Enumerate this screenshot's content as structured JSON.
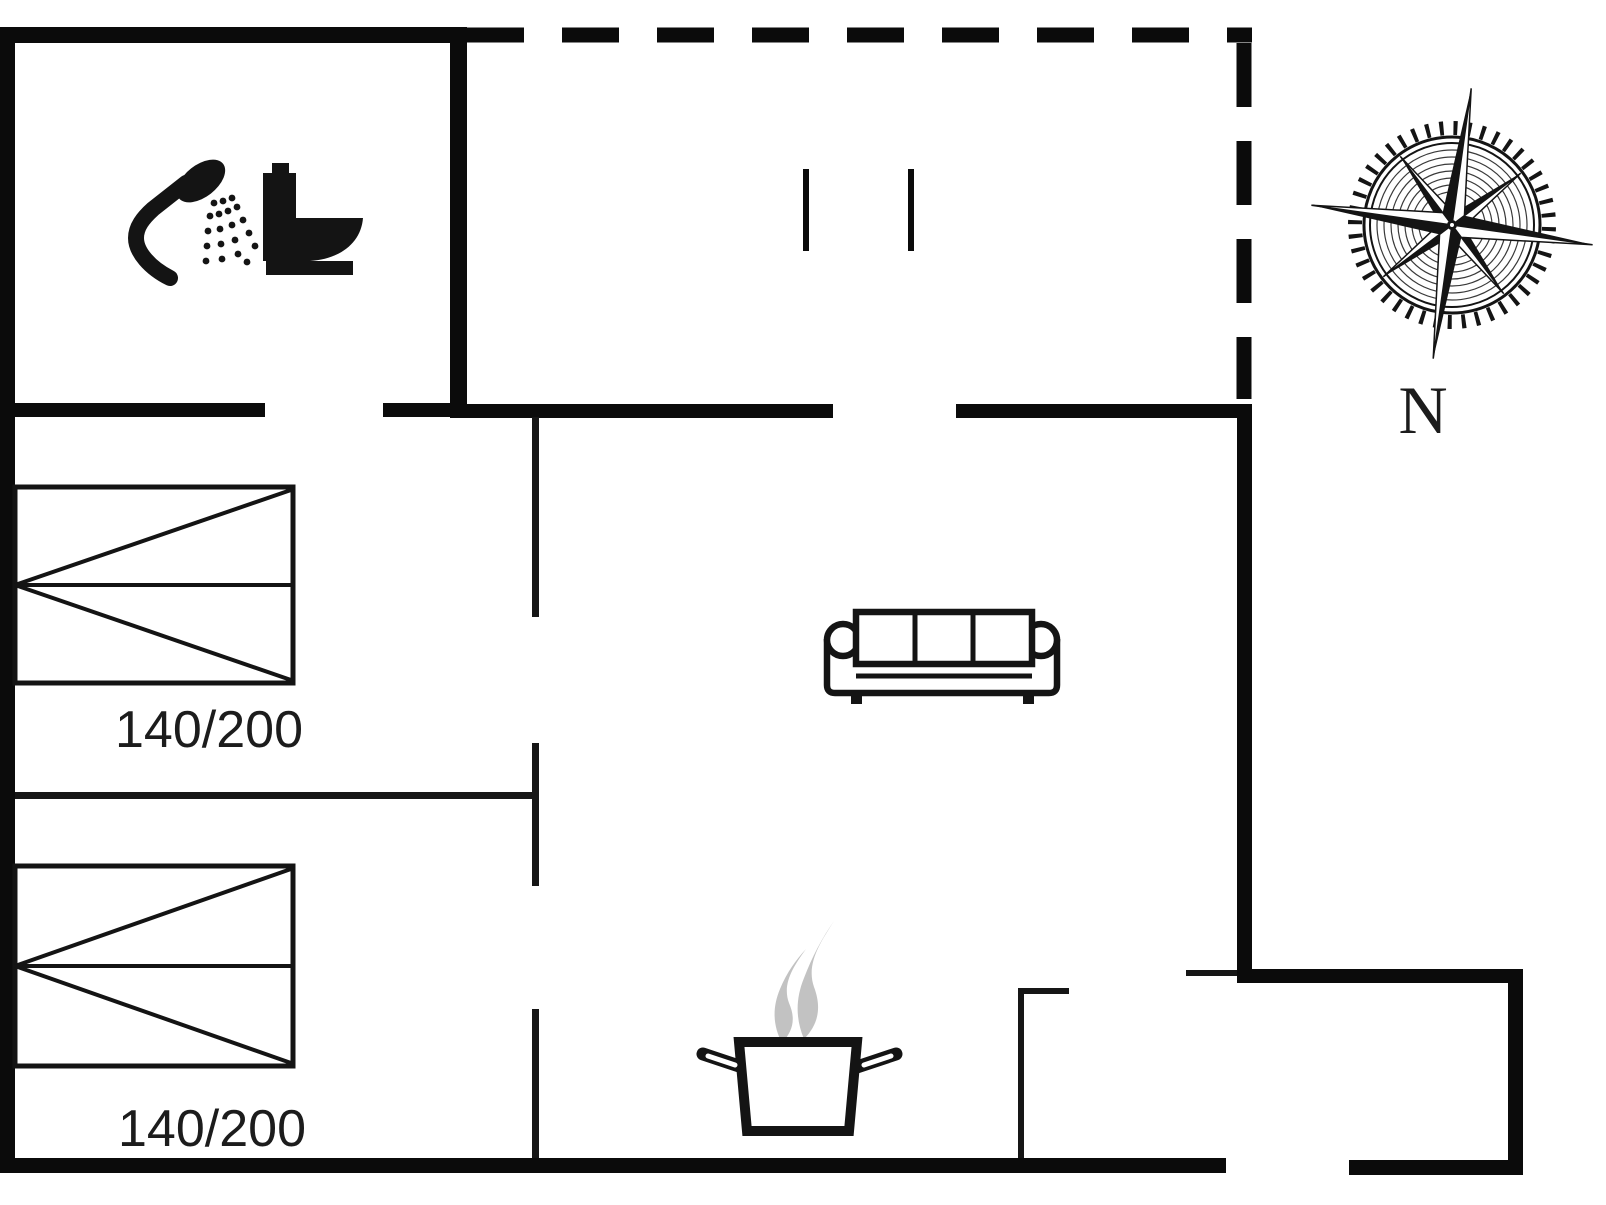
{
  "meta": {
    "type": "floor-plan",
    "title": "Holiday house floor plan"
  },
  "canvas": {
    "width": 1606,
    "height": 1205,
    "background": "#ffffff"
  },
  "colors": {
    "wall": "#0b0b0b",
    "thin_wall": "#161616",
    "icon": "#141414",
    "steam": "#c2c2c2",
    "text": "#1c1c1c",
    "white": "#ffffff",
    "engrave": "#3a3a3a"
  },
  "labels": {
    "bed1": "140/200",
    "bed2": "140/200",
    "north": "N"
  },
  "compass": {
    "cx": 1452,
    "cy": 225,
    "rotation_deg": 8
  },
  "shapes": [
    {
      "name": "wall-bathroom-top",
      "type": "rect",
      "x": 0,
      "y": 27,
      "w": 467,
      "h": 16
    },
    {
      "name": "wall-outer-left",
      "type": "rect",
      "x": 0,
      "y": 27,
      "w": 15,
      "h": 1146
    },
    {
      "name": "wall-bathroom-right",
      "type": "rect",
      "x": 450,
      "y": 27,
      "w": 17,
      "h": 391
    },
    {
      "name": "wall-bathroom-bottom-a",
      "type": "rect",
      "x": 15,
      "y": 403,
      "w": 250,
      "h": 14
    },
    {
      "name": "wall-bathroom-bottom-b",
      "type": "rect",
      "x": 383,
      "y": 403,
      "w": 67,
      "h": 14
    },
    {
      "name": "wall-hall-top",
      "type": "rect",
      "x": 467,
      "y": 404,
      "w": 366,
      "h": 14
    },
    {
      "name": "wall-living-top",
      "type": "rect",
      "x": 956,
      "y": 404,
      "w": 296,
      "h": 14
    },
    {
      "name": "wall-living-right",
      "type": "rect",
      "x": 1237,
      "y": 404,
      "w": 15,
      "h": 579
    },
    {
      "name": "wall-annex-top",
      "type": "rect",
      "x": 1237,
      "y": 969,
      "w": 286,
      "h": 14
    },
    {
      "name": "wall-annex-right",
      "type": "rect",
      "x": 1508,
      "y": 969,
      "w": 15,
      "h": 206
    },
    {
      "name": "wall-bottom-main",
      "type": "rect",
      "x": 0,
      "y": 1158,
      "w": 1226,
      "h": 15
    },
    {
      "name": "wall-bottom-annex",
      "type": "rect",
      "x": 1349,
      "y": 1160,
      "w": 174,
      "h": 15
    },
    {
      "name": "wall-hall-upper",
      "type": "rect",
      "x": 532,
      "y": 417,
      "w": 7,
      "h": 200,
      "fill": "#161616"
    },
    {
      "name": "wall-hall-middle",
      "type": "rect",
      "x": 532,
      "y": 743,
      "w": 7,
      "h": 143,
      "fill": "#161616"
    },
    {
      "name": "wall-hall-lower",
      "type": "rect",
      "x": 532,
      "y": 1009,
      "w": 7,
      "h": 149,
      "fill": "#161616"
    },
    {
      "name": "wall-bedroom-divider",
      "type": "rect",
      "x": 15,
      "y": 792,
      "w": 520,
      "h": 7,
      "fill": "#161616"
    },
    {
      "name": "wall-kitchen-vertical",
      "type": "rect",
      "x": 1018,
      "y": 988,
      "w": 6,
      "h": 170,
      "fill": "#161616"
    },
    {
      "name": "wall-kitchen-stub",
      "type": "rect",
      "x": 1018,
      "y": 988,
      "w": 51,
      "h": 6,
      "fill": "#161616"
    },
    {
      "name": "wall-annex-stub",
      "type": "rect",
      "x": 1186,
      "y": 970,
      "w": 51,
      "h": 6,
      "fill": "#161616"
    },
    {
      "name": "wall-terrace-top-dashed",
      "type": "line",
      "x1": 467,
      "y1": 35,
      "x2": 1252,
      "y2": 35,
      "sw": 15,
      "dash": "57 38"
    },
    {
      "name": "wall-terrace-right-dashed",
      "type": "line",
      "x1": 1244,
      "y1": 43,
      "x2": 1244,
      "y2": 399,
      "sw": 15,
      "dash": "64 34"
    },
    {
      "name": "terrace-door-mark-left",
      "type": "rect",
      "x": 803,
      "y": 169,
      "w": 6,
      "h": 82
    },
    {
      "name": "terrace-door-mark-right",
      "type": "rect",
      "x": 908,
      "y": 169,
      "w": 6,
      "h": 82
    },
    {
      "name": "bed1-frame",
      "type": "rect",
      "x": 15,
      "y": 487,
      "w": 278,
      "h": 196,
      "fill": "#ffffff",
      "stroke": "#141414",
      "sw": 5
    },
    {
      "name": "bed1-midline",
      "type": "line",
      "x1": 15,
      "y1": 585,
      "x2": 293,
      "y2": 585,
      "sw": 4,
      "stroke": "#141414"
    },
    {
      "name": "bed1-diag-up",
      "type": "line",
      "x1": 15,
      "y1": 585,
      "x2": 291,
      "y2": 490,
      "sw": 4,
      "stroke": "#141414"
    },
    {
      "name": "bed1-diag-down",
      "type": "line",
      "x1": 15,
      "y1": 585,
      "x2": 291,
      "y2": 680,
      "sw": 4,
      "stroke": "#141414"
    },
    {
      "name": "bed2-frame",
      "type": "rect",
      "x": 15,
      "y": 866,
      "w": 278,
      "h": 200,
      "fill": "#ffffff",
      "stroke": "#141414",
      "sw": 5
    },
    {
      "name": "bed2-midline",
      "type": "line",
      "x1": 15,
      "y1": 966,
      "x2": 293,
      "y2": 966,
      "sw": 4,
      "stroke": "#141414"
    },
    {
      "name": "bed2-diag-up",
      "type": "line",
      "x1": 15,
      "y1": 966,
      "x2": 291,
      "y2": 869,
      "sw": 4,
      "stroke": "#141414"
    },
    {
      "name": "bed2-diag-down",
      "type": "line",
      "x1": 15,
      "y1": 966,
      "x2": 291,
      "y2": 1063,
      "sw": 4,
      "stroke": "#141414"
    },
    {
      "name": "sofa-foot-left",
      "type": "rect",
      "x": 851,
      "y": 691,
      "w": 11,
      "h": 13,
      "fill": "#141414"
    },
    {
      "name": "sofa-foot-right",
      "type": "rect",
      "x": 1023,
      "y": 691,
      "w": 11,
      "h": 13,
      "fill": "#141414"
    },
    {
      "name": "sofa-frame",
      "type": "path",
      "d": "M 827,639 L 827,685 Q 827,693 835,693 L 1049,693 Q 1057,693 1057,685 L 1057,639",
      "fill": "#ffffff",
      "stroke": "#141414",
      "sw": 6.5
    },
    {
      "name": "sofa-arm-left",
      "type": "circle",
      "cx": 843,
      "cy": 640,
      "r": 16,
      "fill": "#ffffff",
      "stroke": "#141414",
      "sw": 6.5
    },
    {
      "name": "sofa-arm-right",
      "type": "circle",
      "cx": 1041,
      "cy": 640,
      "r": 16,
      "fill": "#ffffff",
      "stroke": "#141414",
      "sw": 6.5
    },
    {
      "name": "sofa-cushions",
      "type": "rect",
      "x": 856,
      "y": 612,
      "w": 176,
      "h": 52,
      "fill": "#ffffff",
      "stroke": "#141414",
      "sw": 6.5
    },
    {
      "name": "sofa-cushion-div1",
      "type": "line",
      "x1": 915,
      "y1": 612,
      "x2": 915,
      "y2": 664,
      "sw": 5,
      "stroke": "#141414"
    },
    {
      "name": "sofa-cushion-div2",
      "type": "line",
      "x1": 973,
      "y1": 612,
      "x2": 973,
      "y2": 664,
      "sw": 5,
      "stroke": "#141414"
    },
    {
      "name": "sofa-seat-edge",
      "type": "line",
      "x1": 856,
      "y1": 676,
      "x2": 1032,
      "y2": 676,
      "sw": 5,
      "stroke": "#141414"
    },
    {
      "name": "steam-wisp-left",
      "type": "path",
      "d": "M 806,949 C 793,967 782,984 789,1003 C 796,1019 793,1031 782,1043 C 773,1026 772,1008 780,989 C 787,972 796,960 806,949 Z",
      "fill": "#c2c2c2"
    },
    {
      "name": "steam-wisp-right",
      "type": "path",
      "d": "M 834,921 C 820,943 806,964 814,987 C 822,1008 818,1025 804,1039 C 796,1020 795,1000 804,978 C 812,957 822,938 834,921 Z",
      "fill": "#c2c2c2"
    },
    {
      "name": "pot-handle-left",
      "type": "line",
      "x1": 703,
      "y1": 1054,
      "x2": 745,
      "y2": 1068,
      "sw": 13,
      "stroke": "#141414",
      "cap": "round"
    },
    {
      "name": "pot-handle-right",
      "type": "line",
      "x1": 896,
      "y1": 1054,
      "x2": 854,
      "y2": 1068,
      "sw": 13,
      "stroke": "#141414",
      "cap": "round"
    },
    {
      "name": "pot-body",
      "type": "path",
      "d": "M 739,1042 L 857,1042 L 849,1131 L 747,1131 Z",
      "fill": "#ffffff",
      "stroke": "#141414",
      "sw": 10
    },
    {
      "name": "pot-handle-left-inner",
      "type": "line",
      "x1": 708,
      "y1": 1056,
      "x2": 735,
      "y2": 1065,
      "sw": 5,
      "stroke": "#ffffff",
      "cap": "round"
    },
    {
      "name": "pot-handle-right-inner",
      "type": "line",
      "x1": 891,
      "y1": 1056,
      "x2": 864,
      "y2": 1065,
      "sw": 5,
      "stroke": "#ffffff",
      "cap": "round"
    },
    {
      "name": "shower-arm-icon",
      "type": "path",
      "d": "M 170,278 C 150,268 136,252 136,238 C 136,227 143,218 153,209 L 186,183",
      "fill": "none",
      "stroke": "#141414",
      "sw": 16,
      "cap": "round"
    },
    {
      "name": "shower-head-icon",
      "type": "ellipse",
      "cx": 0,
      "cy": 0,
      "rx": 28,
      "ry": 16,
      "fill": "#141414",
      "transform": "translate(201,181) rotate(-38)"
    },
    {
      "name": "shower-spray-dots",
      "type": "dots",
      "r": 3.4,
      "fill": "#141414",
      "pts": [
        [
          214,
          203
        ],
        [
          223,
          201
        ],
        [
          232,
          198
        ],
        [
          210,
          216
        ],
        [
          208,
          231
        ],
        [
          207,
          246
        ],
        [
          206,
          261
        ],
        [
          219,
          214
        ],
        [
          220,
          229
        ],
        [
          221,
          244
        ],
        [
          222,
          259
        ],
        [
          228,
          211
        ],
        [
          232,
          225
        ],
        [
          235,
          240
        ],
        [
          238,
          254
        ],
        [
          237,
          207
        ],
        [
          243,
          220
        ],
        [
          249,
          233
        ],
        [
          255,
          246
        ],
        [
          247,
          262
        ]
      ]
    },
    {
      "name": "toilet-cap-icon",
      "type": "rect",
      "x": 272,
      "y": 163,
      "w": 17,
      "h": 12,
      "fill": "#141414"
    },
    {
      "name": "toilet-tank-icon",
      "type": "rect",
      "x": 263,
      "y": 173,
      "w": 33,
      "h": 72,
      "fill": "#141414"
    },
    {
      "name": "toilet-bowl-icon",
      "type": "path",
      "d": "M 263,218 L 363,218 C 361,243 340,259 310,261 L 263,261 Z",
      "fill": "#141414"
    },
    {
      "name": "toilet-base-icon",
      "type": "rect",
      "x": 266,
      "y": 261,
      "w": 87,
      "h": 14,
      "fill": "#141414"
    },
    {
      "name": "compass-tick-ring",
      "type": "circle",
      "cx": 0,
      "cy": 0,
      "r": 97,
      "fill": "none",
      "stroke": "#141414",
      "sw": 14,
      "dash": "4 9.9",
      "layer": "compass"
    },
    {
      "name": "compass-ring-outer",
      "type": "circle",
      "cx": 0,
      "cy": 0,
      "r": 88,
      "fill": "none",
      "stroke": "#141414",
      "sw": 3,
      "layer": "compass"
    },
    {
      "name": "compass-ring-inner",
      "type": "circle",
      "cx": 0,
      "cy": 0,
      "r": 82,
      "fill": "none",
      "stroke": "#141414",
      "sw": 2,
      "layer": "compass"
    },
    {
      "name": "compass-engrave-1",
      "type": "circle",
      "cx": 0,
      "cy": 0,
      "r": 75,
      "fill": "none",
      "stroke": "#3a3a3a",
      "sw": 1.2,
      "layer": "compass"
    },
    {
      "name": "compass-engrave-2",
      "type": "circle",
      "cx": 0,
      "cy": 0,
      "r": 68,
      "fill": "none",
      "stroke": "#3a3a3a",
      "sw": 1.2,
      "layer": "compass"
    },
    {
      "name": "compass-engrave-3",
      "type": "circle",
      "cx": 0,
      "cy": 0,
      "r": 61,
      "fill": "none",
      "stroke": "#3a3a3a",
      "sw": 1.2,
      "layer": "compass"
    },
    {
      "name": "compass-engrave-4",
      "type": "circle",
      "cx": 0,
      "cy": 0,
      "r": 54,
      "fill": "none",
      "stroke": "#3a3a3a",
      "sw": 1.2,
      "layer": "compass"
    },
    {
      "name": "compass-engrave-5",
      "type": "circle",
      "cx": 0,
      "cy": 0,
      "r": 47,
      "fill": "none",
      "stroke": "#3a3a3a",
      "sw": 1.2,
      "layer": "compass"
    },
    {
      "name": "compass-engrave-6",
      "type": "circle",
      "cx": 0,
      "cy": 0,
      "r": 40,
      "fill": "none",
      "stroke": "#3a3a3a",
      "sw": 1.2,
      "layer": "compass"
    },
    {
      "name": "compass-engrave-7",
      "type": "circle",
      "cx": 0,
      "cy": 0,
      "r": 33,
      "fill": "none",
      "stroke": "#3a3a3a",
      "sw": 1.2,
      "layer": "compass"
    },
    {
      "name": "compass-point-ne-black",
      "type": "poly",
      "points": "60.8,-60.8 0,-12 0,0",
      "fill": "#141414",
      "layer": "compass"
    },
    {
      "name": "compass-point-ne-white",
      "type": "poly",
      "points": "60.8,-60.8 12,0 0,0",
      "fill": "#ffffff",
      "stroke": "#141414",
      "sw": 1.5,
      "layer": "compass"
    },
    {
      "name": "compass-point-se-black",
      "type": "poly",
      "points": "60.8,60.8 12,0 0,0",
      "fill": "#141414",
      "layer": "compass"
    },
    {
      "name": "compass-point-se-white",
      "type": "poly",
      "points": "60.8,60.8 0,12 0,0",
      "fill": "#ffffff",
      "stroke": "#141414",
      "sw": 1.5,
      "layer": "compass"
    },
    {
      "name": "compass-point-sw-black",
      "type": "poly",
      "points": "-60.8,60.8 0,12 0,0",
      "fill": "#141414",
      "layer": "compass"
    },
    {
      "name": "compass-point-sw-white",
      "type": "poly",
      "points": "-60.8,60.8 -12,0 0,0",
      "fill": "#ffffff",
      "stroke": "#141414",
      "sw": 1.5,
      "layer": "compass"
    },
    {
      "name": "compass-point-nw-black",
      "type": "poly",
      "points": "-60.8,-60.8 -12,0 0,0",
      "fill": "#141414",
      "layer": "compass"
    },
    {
      "name": "compass-point-nw-white",
      "type": "poly",
      "points": "-60.8,-60.8 0,-12 0,0",
      "fill": "#ffffff",
      "stroke": "#141414",
      "sw": 1.5,
      "layer": "compass"
    },
    {
      "name": "compass-point-n-black",
      "type": "poly",
      "points": "0,-138 -11,-11 0,0",
      "fill": "#141414",
      "layer": "compass"
    },
    {
      "name": "compass-point-n-white",
      "type": "poly",
      "points": "0,-138 11,-11 0,0",
      "fill": "#ffffff",
      "stroke": "#141414",
      "sw": 1.5,
      "layer": "compass"
    },
    {
      "name": "compass-point-e-black",
      "type": "poly",
      "points": "142,0 11,-11 0,0",
      "fill": "#141414",
      "layer": "compass"
    },
    {
      "name": "compass-point-e-white",
      "type": "poly",
      "points": "142,0 11,11 0,0",
      "fill": "#ffffff",
      "stroke": "#141414",
      "sw": 1.5,
      "layer": "compass"
    },
    {
      "name": "compass-point-s-black",
      "type": "poly",
      "points": "0,135 11,11 0,0",
      "fill": "#141414",
      "layer": "compass"
    },
    {
      "name": "compass-point-s-white",
      "type": "poly",
      "points": "0,135 -11,11 0,0",
      "fill": "#ffffff",
      "stroke": "#141414",
      "sw": 1.5,
      "layer": "compass"
    },
    {
      "name": "compass-point-w-black",
      "type": "poly",
      "points": "-142,0 -11,11 0,0",
      "fill": "#141414",
      "layer": "compass"
    },
    {
      "name": "compass-point-w-white",
      "type": "poly",
      "points": "-142,0 -11,-11 0,0",
      "fill": "#ffffff",
      "stroke": "#141414",
      "sw": 1.5,
      "layer": "compass"
    },
    {
      "name": "compass-hub-outer",
      "type": "circle",
      "cx": 0,
      "cy": 0,
      "r": 5,
      "fill": "#141414",
      "layer": "compass"
    },
    {
      "name": "compass-hub-inner",
      "type": "circle",
      "cx": 0,
      "cy": 0,
      "r": 2,
      "fill": "#ffffff",
      "layer": "compass"
    }
  ]
}
